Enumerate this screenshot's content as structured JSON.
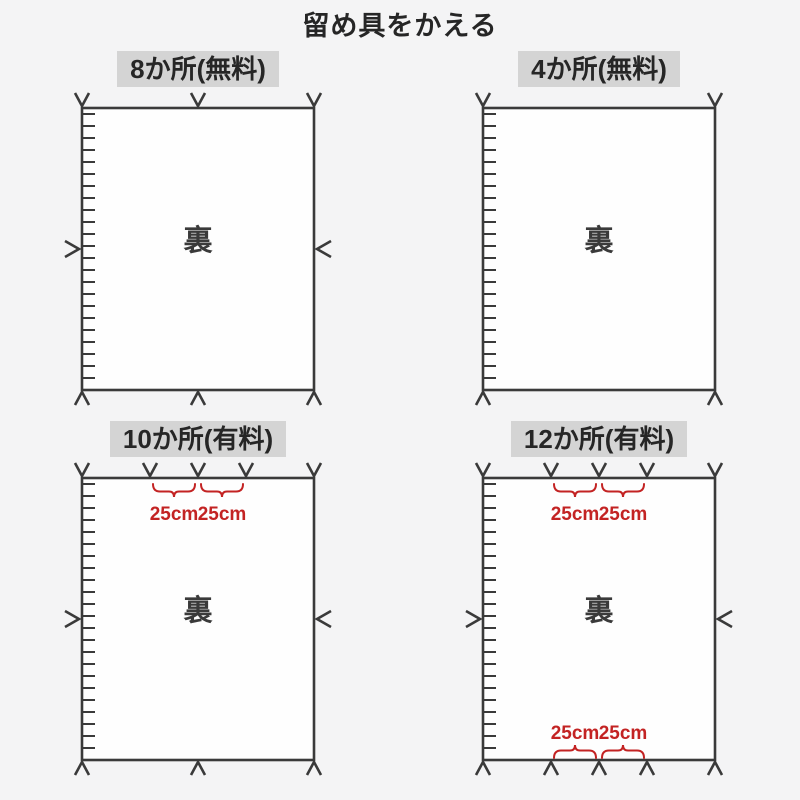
{
  "title": "留め具をかえる",
  "colors": {
    "background": "#f4f4f5",
    "line": "#3a3a3a",
    "label_background": "#d4d4d4",
    "fabric": "#fefefe",
    "accent_red": "#c32323"
  },
  "panels": [
    {
      "label": "8か所(無料)",
      "back_label": "裏",
      "fastener_marks": {
        "top": 3,
        "bottom": 3,
        "left": 1,
        "right": 1
      }
    },
    {
      "label": "4か所(無料)",
      "back_label": "裏",
      "fastener_marks": {
        "top": 2,
        "bottom": 2,
        "left": 0,
        "right": 0
      }
    },
    {
      "label": "10か所(有料)",
      "back_label": "裏",
      "fastener_marks": {
        "top": 5,
        "bottom": 3,
        "left": 1,
        "right": 1
      },
      "top_measures": [
        "25cm",
        "25cm"
      ]
    },
    {
      "label": "12か所(有料)",
      "back_label": "裏",
      "fastener_marks": {
        "top": 5,
        "bottom": 5,
        "left": 1,
        "right": 1
      },
      "top_measures": [
        "25cm",
        "25cm"
      ],
      "bottom_measures": [
        "25cm",
        "25cm"
      ]
    }
  ]
}
